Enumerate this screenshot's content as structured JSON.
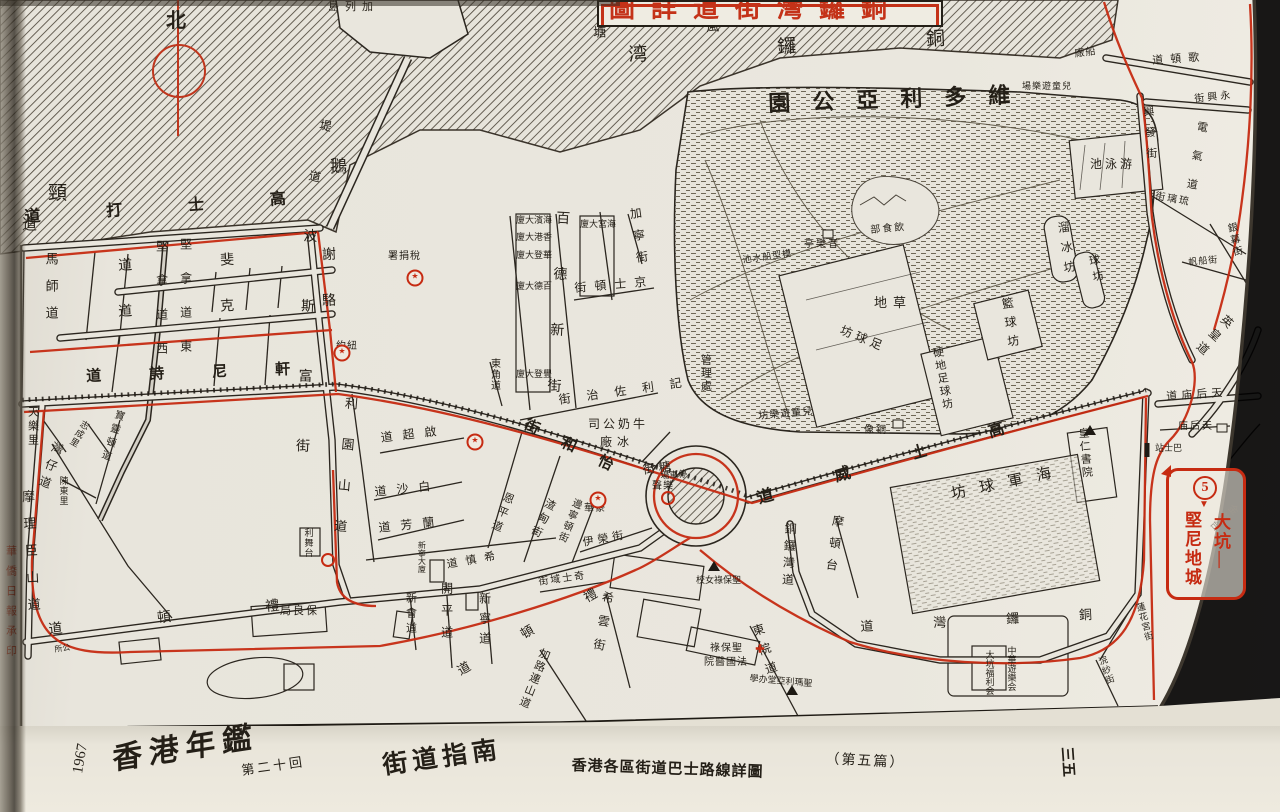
{
  "title_box": {
    "text": "銅鑼灣街道詳圖"
  },
  "compass": {
    "label": "北"
  },
  "route_badge": {
    "number": "5",
    "from": "大坑",
    "to": "堅尼地城",
    "destination": "大坑—堅尼地城"
  },
  "margin_note": "華僑日報承印",
  "caption": {
    "year": "1967",
    "book": "香港年鑑",
    "edition": "第二十回",
    "section": "街道指南",
    "series": "香港各區街道巴士路線詳圖",
    "part": "（第五篇）",
    "page": "三五"
  },
  "colors": {
    "ink": "#241f17",
    "route_red": "#c62b12",
    "paper": "#eae7de"
  },
  "labels": [
    {
      "t": "避風塘",
      "m": "rtl",
      "x": 593,
      "y": 26,
      "fs": 13,
      "ls": 100,
      "r": -3
    },
    {
      "t": "銅鑼湾",
      "m": "rtl",
      "x": 628,
      "y": 46,
      "fs": 19,
      "ls": 130,
      "r": -3
    },
    {
      "t": "加列島",
      "m": "rtl",
      "x": 328,
      "y": 2,
      "fs": 11,
      "ls": 6
    },
    {
      "t": "堤道",
      "m": "v",
      "x": 320,
      "y": 118,
      "fs": 12,
      "ls": 40,
      "r": 12
    },
    {
      "t": "鵝",
      "m": "h",
      "x": 330,
      "y": 158,
      "fs": 17
    },
    {
      "t": "頸",
      "m": "h",
      "x": 48,
      "y": 184,
      "fs": 19
    },
    {
      "t": "道",
      "m": "h",
      "x": 22,
      "y": 218,
      "fs": 15
    },
    {
      "t": "維多利亞公園",
      "m": "rtl",
      "x": 768,
      "y": 92,
      "fs": 22,
      "ls": 22,
      "r": -2,
      "b": 1
    },
    {
      "t": "游泳池",
      "m": "rtl",
      "x": 1090,
      "y": 158,
      "fs": 12,
      "ls": 3
    },
    {
      "t": "溜冰坊",
      "m": "v",
      "x": 1056,
      "y": 222,
      "fs": 12,
      "ls": 8,
      "r": -8
    },
    {
      "t": "球坊",
      "m": "v",
      "x": 1086,
      "y": 256,
      "fs": 11,
      "ls": 5,
      "r": -12
    },
    {
      "t": "籃球坊",
      "m": "v",
      "x": 1000,
      "y": 298,
      "fs": 12,
      "ls": 7,
      "r": -8
    },
    {
      "t": "草地",
      "m": "rtl",
      "x": 874,
      "y": 296,
      "fs": 13,
      "ls": 6
    },
    {
      "t": "足球坊",
      "m": "rtl",
      "x": 843,
      "y": 324,
      "fs": 12,
      "ls": 4,
      "r": 22
    },
    {
      "t": "硬地足球坊",
      "m": "v",
      "x": 930,
      "y": 348,
      "fs": 11,
      "ls": 2,
      "r": -10
    },
    {
      "t": "管理處",
      "m": "v",
      "x": 699,
      "y": 354,
      "fs": 11,
      "ls": 2
    },
    {
      "t": "音樂亭",
      "m": "rtl",
      "x": 804,
      "y": 240,
      "fs": 10,
      "ls": 2
    },
    {
      "t": "飲食部",
      "m": "rtl",
      "x": 870,
      "y": 226,
      "fs": 10,
      "ls": 2,
      "r": -5
    },
    {
      "t": "模型船水池",
      "m": "rtl",
      "x": 742,
      "y": 256,
      "fs": 9,
      "ls": 1,
      "r": -8
    },
    {
      "t": "兒童遊樂場",
      "m": "rtl",
      "x": 1022,
      "y": 82,
      "fs": 9,
      "ls": 1
    },
    {
      "t": "兒童遊樂坊",
      "m": "rtl",
      "x": 758,
      "y": 412,
      "fs": 10,
      "ls": 1,
      "r": -5
    },
    {
      "t": "銅像",
      "m": "rtl",
      "x": 864,
      "y": 426,
      "fs": 10,
      "ls": 2
    },
    {
      "t": "船廠",
      "m": "rtl",
      "x": 1074,
      "y": 50,
      "fs": 10,
      "ls": 1,
      "r": -8
    },
    {
      "t": "歌頓道",
      "m": "rtl",
      "x": 1152,
      "y": 56,
      "fs": 11,
      "ls": 7,
      "r": -4
    },
    {
      "t": "永興街",
      "m": "rtl",
      "x": 1194,
      "y": 95,
      "fs": 10,
      "ls": 3,
      "r": -6
    },
    {
      "t": "興發街",
      "m": "v",
      "x": 1141,
      "y": 106,
      "fs": 11,
      "ls": 10,
      "r": -4
    },
    {
      "t": "電氣道",
      "m": "v",
      "x": 1196,
      "y": 120,
      "fs": 11,
      "ls": 18,
      "r": 10
    },
    {
      "t": "琉璃街",
      "m": "rtl",
      "x": 1156,
      "y": 192,
      "fs": 10,
      "ls": 2,
      "r": 10
    },
    {
      "t": "銀幕街",
      "m": "v",
      "x": 1224,
      "y": 224,
      "fs": 10,
      "ls": 2,
      "r": -12
    },
    {
      "t": "帆船街",
      "m": "h",
      "x": 1188,
      "y": 258,
      "fs": 9,
      "ls": 1,
      "r": -5
    },
    {
      "t": "英皇道",
      "m": "v",
      "x": 1226,
      "y": 312,
      "fs": 12,
      "ls": 6,
      "r": 42
    },
    {
      "t": "天后庙道",
      "m": "rtl",
      "x": 1166,
      "y": 392,
      "fs": 11,
      "ls": 4,
      "r": -4
    },
    {
      "t": "天后庙",
      "m": "rtl",
      "x": 1178,
      "y": 422,
      "fs": 10,
      "ls": 2
    },
    {
      "t": "巴士站",
      "m": "rtl",
      "x": 1155,
      "y": 444,
      "fs": 9,
      "ls": 0
    },
    {
      "t": "金龍台",
      "m": "v",
      "x": 1232,
      "y": 500,
      "fs": 10,
      "ls": 2,
      "r": 48
    },
    {
      "t": "蓮花宮街",
      "m": "v",
      "x": 1134,
      "y": 604,
      "fs": 9,
      "ls": 1,
      "r": -15
    },
    {
      "t": "浣紗街",
      "m": "v",
      "x": 1096,
      "y": 658,
      "fs": 9,
      "ls": 1,
      "r": -20
    },
    {
      "t": "高士打道",
      "m": "rtl",
      "x": 24,
      "y": 210,
      "fs": 16,
      "ls": 66,
      "r": -4,
      "b": 1
    },
    {
      "t": "謝斐道",
      "m": "rtl",
      "x": 118,
      "y": 260,
      "fs": 14,
      "ls": 88,
      "r": -3
    },
    {
      "t": "駱克道",
      "m": "rtl",
      "x": 118,
      "y": 306,
      "fs": 14,
      "ls": 88,
      "r": -3
    },
    {
      "t": "軒尼詩道",
      "m": "rtl",
      "x": 86,
      "y": 370,
      "fs": 15,
      "ls": 48,
      "r": -2,
      "b": 1
    },
    {
      "t": "波斯富街",
      "m": "v",
      "x": 301,
      "y": 228,
      "fs": 14,
      "ls": 56,
      "r": 2
    },
    {
      "t": "馬師道",
      "m": "v",
      "x": 44,
      "y": 252,
      "fs": 13,
      "ls": 14
    },
    {
      "t": "堅拿道西",
      "m": "v",
      "x": 155,
      "y": 240,
      "fs": 12,
      "ls": 22
    },
    {
      "t": "堅拿道東",
      "m": "v",
      "x": 179,
      "y": 238,
      "fs": 12,
      "ls": 22
    },
    {
      "t": "怡和街",
      "m": "rtl",
      "x": 528,
      "y": 418,
      "fs": 15,
      "ls": 26,
      "r": 26,
      "b": 1
    },
    {
      "t": "高士威道",
      "m": "rtl",
      "x": 756,
      "y": 492,
      "fs": 16,
      "ls": 64,
      "r": -16,
      "b": 1
    },
    {
      "t": "禮頓道",
      "m": "rtl",
      "x": 48,
      "y": 624,
      "fs": 14,
      "ls": 95,
      "r": -6
    },
    {
      "t": "禮頓道",
      "m": "rtl",
      "x": 455,
      "y": 666,
      "fs": 13,
      "ls": 60,
      "r": -30
    },
    {
      "t": "銅鑼灣道",
      "m": "rtl",
      "x": 860,
      "y": 620,
      "fs": 13,
      "ls": 60,
      "r": -3
    },
    {
      "t": "銅鑼灣道",
      "m": "v",
      "x": 784,
      "y": 522,
      "fs": 12,
      "ls": 5,
      "r": 3
    },
    {
      "t": "天樂里",
      "m": "v",
      "x": 26,
      "y": 406,
      "fs": 11,
      "ls": 3
    },
    {
      "t": "摩理臣山道",
      "m": "v",
      "x": 20,
      "y": 490,
      "fs": 13,
      "ls": 14,
      "r": -3
    },
    {
      "t": "灣仔道",
      "m": "v",
      "x": 53,
      "y": 440,
      "fs": 12,
      "ls": 6,
      "r": 20
    },
    {
      "t": "寶靈頓道",
      "m": "v",
      "x": 114,
      "y": 408,
      "fs": 10,
      "ls": 4,
      "r": 18
    },
    {
      "t": "志成里",
      "m": "v",
      "x": 82,
      "y": 418,
      "fs": 9,
      "ls": 1,
      "r": 30
    },
    {
      "t": "陳東里",
      "m": "v",
      "x": 58,
      "y": 476,
      "fs": 9,
      "ls": 1
    },
    {
      "t": "公所",
      "m": "rtl",
      "x": 54,
      "y": 646,
      "fs": 8,
      "ls": 0,
      "r": -8
    },
    {
      "t": "保良局",
      "m": "rtl",
      "x": 280,
      "y": 606,
      "fs": 11,
      "ls": 2
    },
    {
      "t": "利園山道",
      "m": "v",
      "x": 344,
      "y": 396,
      "fs": 13,
      "ls": 28,
      "r": 5
    },
    {
      "t": "啟超道",
      "m": "rtl",
      "x": 380,
      "y": 432,
      "fs": 12,
      "ls": 10,
      "r": -7
    },
    {
      "t": "白沙道",
      "m": "rtl",
      "x": 374,
      "y": 486,
      "fs": 12,
      "ls": 10,
      "r": -6
    },
    {
      "t": "蘭芳道",
      "m": "rtl",
      "x": 378,
      "y": 522,
      "fs": 12,
      "ls": 10,
      "r": -6
    },
    {
      "t": "希慎道",
      "m": "rtl",
      "x": 446,
      "y": 560,
      "fs": 11,
      "ls": 8,
      "r": -10
    },
    {
      "t": "恩平道",
      "m": "v",
      "x": 504,
      "y": 490,
      "fs": 11,
      "ls": 4,
      "r": 22
    },
    {
      "t": "渣甸街",
      "m": "v",
      "x": 546,
      "y": 496,
      "fs": 11,
      "ls": 4,
      "r": 26
    },
    {
      "t": "邊寧頓街",
      "m": "v",
      "x": 572,
      "y": 496,
      "fs": 10,
      "ls": 2,
      "r": 22
    },
    {
      "t": "伊榮街",
      "m": "h",
      "x": 582,
      "y": 538,
      "fs": 11,
      "ls": 4,
      "r": -10
    },
    {
      "t": "奇士域街",
      "m": "rtl",
      "x": 538,
      "y": 578,
      "fs": 10,
      "ls": 2,
      "r": -8
    },
    {
      "t": "希雲街",
      "m": "v",
      "x": 602,
      "y": 590,
      "fs": 12,
      "ls": 12,
      "r": 10
    },
    {
      "t": "開平道",
      "m": "v",
      "x": 440,
      "y": 582,
      "fs": 12,
      "ls": 10
    },
    {
      "t": "新寧道",
      "m": "v",
      "x": 478,
      "y": 592,
      "fs": 12,
      "ls": 8
    },
    {
      "t": "新會道",
      "m": "v",
      "x": 404,
      "y": 592,
      "fs": 11,
      "ls": 4
    },
    {
      "t": "加路連山道",
      "m": "v",
      "x": 540,
      "y": 646,
      "fs": 11,
      "ls": 2,
      "r": 22
    },
    {
      "t": "新寧大廈",
      "m": "v",
      "x": 417,
      "y": 541,
      "fs": 8,
      "ls": 0
    },
    {
      "t": "利舞台",
      "m": "v",
      "x": 303,
      "y": 528,
      "fs": 9,
      "ls": 1
    },
    {
      "t": "東角道",
      "m": "v",
      "x": 488,
      "y": 358,
      "fs": 10,
      "ls": 1
    },
    {
      "t": "百德新街",
      "m": "v",
      "x": 554,
      "y": 210,
      "fs": 14,
      "ls": 42,
      "r": 3
    },
    {
      "t": "加寧街",
      "m": "v",
      "x": 628,
      "y": 208,
      "fs": 12,
      "ls": 10,
      "r": -8
    },
    {
      "t": "京士頓街",
      "m": "rtl",
      "x": 574,
      "y": 282,
      "fs": 12,
      "ls": 8,
      "r": -5
    },
    {
      "t": "記利佐治街",
      "m": "rtl",
      "x": 558,
      "y": 394,
      "fs": 12,
      "ls": 16,
      "r": -8
    },
    {
      "t": "糖街",
      "m": "rtl",
      "x": 642,
      "y": 464,
      "fs": 12,
      "ls": 4,
      "r": -8
    },
    {
      "t": "牛奶公司",
      "m": "rtl",
      "x": 588,
      "y": 418,
      "fs": 12,
      "ls": 3
    },
    {
      "t": "冰廠",
      "m": "rtl",
      "x": 600,
      "y": 436,
      "fs": 12,
      "ls": 5
    },
    {
      "t": "停車場",
      "m": "rtl",
      "x": 660,
      "y": 472,
      "fs": 9,
      "ls": 0,
      "r": -5
    },
    {
      "t": "樂聲",
      "m": "rtl",
      "x": 652,
      "y": 482,
      "fs": 10,
      "ls": 1
    },
    {
      "t": "豪華",
      "m": "rtl",
      "x": 584,
      "y": 504,
      "fs": 10,
      "ls": 1
    },
    {
      "t": "紐約",
      "m": "rtl",
      "x": 336,
      "y": 342,
      "fs": 10,
      "ls": 1
    },
    {
      "t": "稅捐署",
      "m": "rtl",
      "x": 388,
      "y": 252,
      "fs": 10,
      "ls": 1
    },
    {
      "t": "海濱大廈",
      "m": "rtl",
      "x": 516,
      "y": 216,
      "fs": 9,
      "ls": 0
    },
    {
      "t": "香港大廈",
      "m": "rtl",
      "x": 516,
      "y": 233,
      "fs": 9,
      "ls": 0
    },
    {
      "t": "華登大廈",
      "m": "rtl",
      "x": 516,
      "y": 251,
      "fs": 9,
      "ls": 0
    },
    {
      "t": "百德大廈",
      "m": "rtl",
      "x": 516,
      "y": 282,
      "fs": 9,
      "ls": 0
    },
    {
      "t": "豐登大廈",
      "m": "rtl",
      "x": 516,
      "y": 370,
      "fs": 9,
      "ls": 0
    },
    {
      "t": "海宮大廈",
      "m": "rtl",
      "x": 580,
      "y": 220,
      "fs": 9,
      "ls": 0
    },
    {
      "t": "摩頓台",
      "m": "v",
      "x": 832,
      "y": 514,
      "fs": 12,
      "ls": 10,
      "r": 8
    },
    {
      "t": "海軍球坊",
      "m": "rtl",
      "x": 950,
      "y": 488,
      "fs": 15,
      "ls": 14,
      "r": -12
    },
    {
      "t": "皇仁書院",
      "m": "v",
      "x": 1076,
      "y": 428,
      "fs": 11,
      "ls": 2,
      "r": -5
    },
    {
      "t": "聖保祿女校",
      "m": "rtl",
      "x": 696,
      "y": 576,
      "fs": 9,
      "ls": 0
    },
    {
      "t": "聖保祿",
      "m": "rtl",
      "x": 710,
      "y": 644,
      "fs": 10,
      "ls": 1
    },
    {
      "t": "法國醫院",
      "m": "rtl",
      "x": 704,
      "y": 658,
      "fs": 10,
      "ls": 1
    },
    {
      "t": "東院道",
      "m": "v",
      "x": 750,
      "y": 626,
      "fs": 12,
      "ls": 8,
      "r": -18
    },
    {
      "t": "聖瑪利亞堂办學",
      "m": "rtl",
      "x": 750,
      "y": 674,
      "fs": 9,
      "ls": 0,
      "r": 5
    },
    {
      "t": "中華遊樂会",
      "m": "v",
      "x": 1006,
      "y": 646,
      "fs": 9,
      "ls": 0
    },
    {
      "t": "大坑福利会",
      "m": "v",
      "x": 984,
      "y": 650,
      "fs": 9,
      "ls": 0
    },
    {
      "t": "華僑日報承印",
      "m": "v",
      "x": 4,
      "y": 545,
      "fs": 11,
      "ls": 9,
      "c": "r"
    }
  ],
  "markers": [
    {
      "type": "star",
      "x": 415,
      "y": 278,
      "n": "tax-office-marker"
    },
    {
      "type": "star",
      "x": 342,
      "y": 353,
      "n": "new-york-theatre-marker"
    },
    {
      "type": "star",
      "x": 475,
      "y": 442,
      "n": "theatre-marker"
    },
    {
      "type": "star",
      "x": 598,
      "y": 500,
      "n": "hoover-theatre-marker"
    },
    {
      "type": "ring",
      "x": 668,
      "y": 498,
      "n": "roxy-theatre-stop-marker"
    },
    {
      "type": "ring",
      "x": 328,
      "y": 560,
      "n": "bus-stop-ring-marker"
    },
    {
      "type": "bus",
      "x": 1147,
      "y": 450,
      "n": "bus-stop-bar"
    },
    {
      "type": "tri",
      "x": 714,
      "y": 566,
      "n": "school-triangle"
    },
    {
      "type": "tri",
      "x": 792,
      "y": 690,
      "n": "church-triangle"
    },
    {
      "type": "tri",
      "x": 1090,
      "y": 430,
      "n": "college-triangle"
    },
    {
      "type": "cross",
      "x": 760,
      "y": 650,
      "n": "hospital-cross"
    },
    {
      "type": "sq",
      "x": 898,
      "y": 424,
      "n": "statue-square"
    },
    {
      "type": "sq",
      "x": 1222,
      "y": 428,
      "n": "temple-square"
    },
    {
      "type": "sq",
      "x": 828,
      "y": 234,
      "n": "pavilion-square"
    }
  ]
}
